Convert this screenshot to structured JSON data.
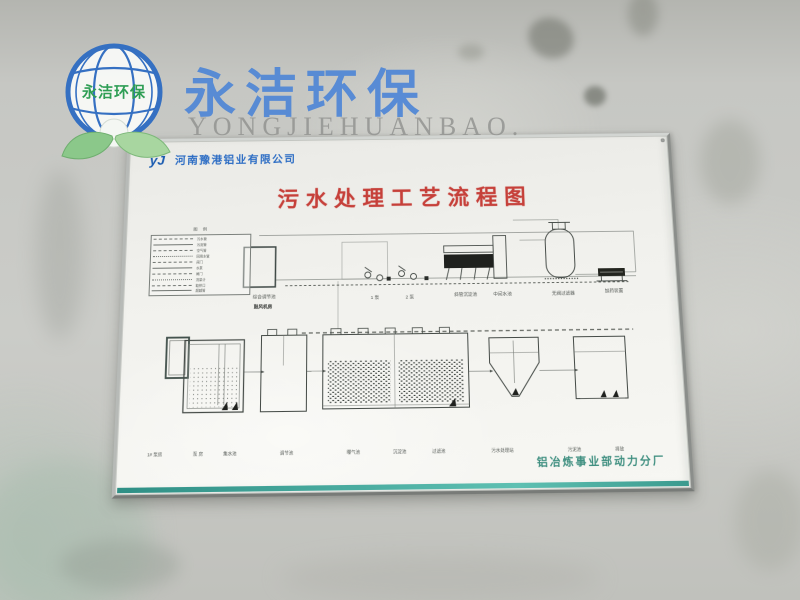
{
  "watermark": {
    "brand_cn": "永洁环保",
    "brand_en": "YONGJIEHUANBAO.",
    "globe_text": "永洁环保"
  },
  "board": {
    "company": "河南豫港铝业有限公司",
    "logo_mark": "yJ",
    "title": "污水处理工艺流程图",
    "caption": "铝冶炼事业部动力分厂",
    "legend": {
      "title": "图 例",
      "rows": [
        "污水管",
        "污泥管",
        "空气管",
        "回用水管",
        "阀门",
        "水泵",
        "闸门",
        "流量计",
        "取样口",
        "超越管"
      ]
    },
    "diagram": {
      "top_labels": {
        "tank": "综合调节池",
        "pump1": "1 泵",
        "pump2": "2 泵",
        "clarifier": "斜管沉淀池",
        "mid_tank": "中间水池",
        "filter": "无阀过滤器",
        "dosing": "加药装置",
        "blower": "鼓风机房"
      },
      "bottom_labels": [
        {
          "x": 28,
          "text": "1# 泵房"
        },
        {
          "x": 70,
          "text": "泵 房"
        },
        {
          "x": 101,
          "text": "集水池"
        },
        {
          "x": 156,
          "text": "调节池"
        },
        {
          "x": 221,
          "text": "曝气池"
        },
        {
          "x": 266,
          "text": "沉淀池"
        },
        {
          "x": 304,
          "text": "过滤池"
        },
        {
          "x": 366,
          "text": "污水处理站"
        },
        {
          "x": 436,
          "text": "污泥池"
        },
        {
          "x": 480,
          "text": "排放"
        }
      ]
    }
  },
  "colors": {
    "brand_blue": "#4f86d6",
    "company_blue": "#2b6cc4",
    "title_red": "#c6403a",
    "caption_teal": "#3f8f80",
    "strip_teal": "#2f8f85"
  }
}
